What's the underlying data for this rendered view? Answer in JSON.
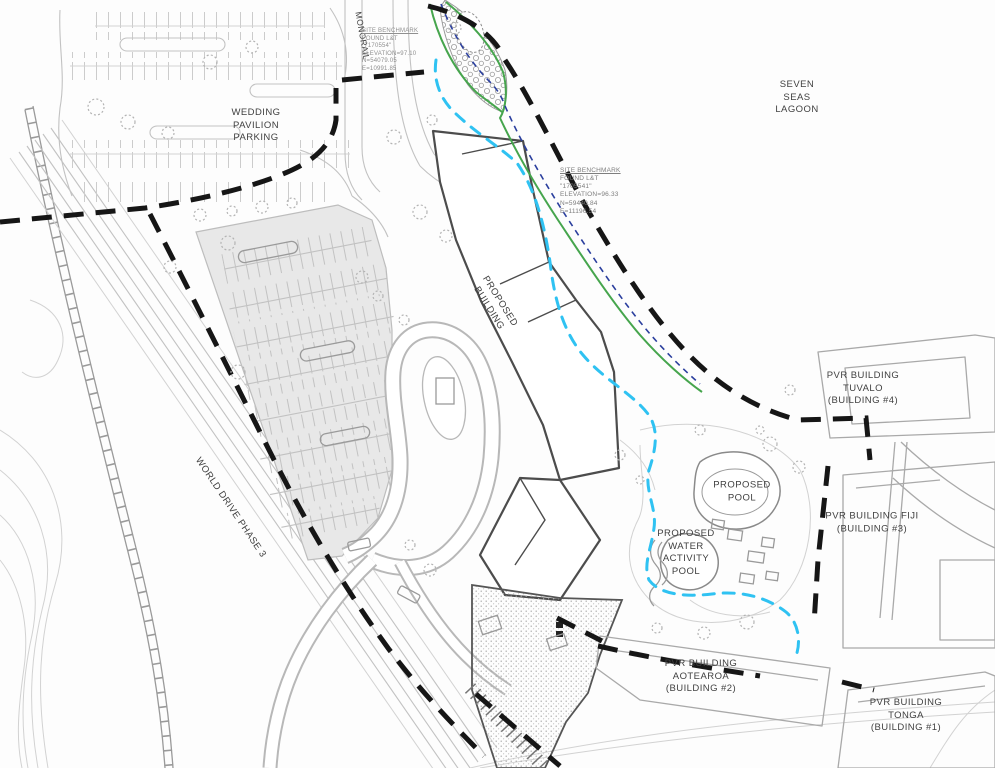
{
  "drawing": {
    "type": "civil site plan",
    "labels": {
      "lagoon": "SEVEN\nSEAS\nLAGOON",
      "wedding_parking": "WEDDING\nPAVILION\nPARKING",
      "monorail": "MONORAIL",
      "world_drive": "WORLD DRIVE PHASE 3",
      "proposed_building": "PROPOSED\nBUILDING",
      "proposed_pool": "PROPOSED\nPOOL",
      "water_activity_pool": "PROPOSED\nWATER\nACTIVITY\nPOOL",
      "pvr_tuvalo": "PVR BUILDING\nTUVALO\n(BUILDING #4)",
      "pvr_fiji": "PVR BUILDING FIJI\n(BUILDING #3)",
      "pvr_aotearoa": "PVR BUILDING\nAOTEAROA\n(BUILDING #2)",
      "pvr_tonga": "PVR BUILDING\nTONGA\n(BUILDING #1)"
    },
    "benchmarks": {
      "north": {
        "line1": "SITE BENCHMARK",
        "line2": "FOUND L&T",
        "line3": "\"7170554\"",
        "line4": "ELEVATION=97.10",
        "line5": "N=54079.05",
        "line6": "E=10991.85"
      },
      "shore": {
        "line1": "SITE BENCHMARK",
        "line2": "FOUND L&T",
        "line3": "\"1705541\"",
        "line4": "ELEVATION=96.33",
        "line5": "N=59440.84",
        "line6": "E=11196.54"
      }
    },
    "colors": {
      "boundary": "#161616",
      "path_cyan": "#2fc2f2",
      "shore_green": "#46a54d",
      "shore_blue": "#2b3f9e",
      "parking_fill": "#e8e8e8",
      "line_light": "#c2c2c2",
      "line_xlight": "#d2d2d2",
      "line_med": "#9a9a9a",
      "building_outline": "#4c4c4c"
    }
  }
}
